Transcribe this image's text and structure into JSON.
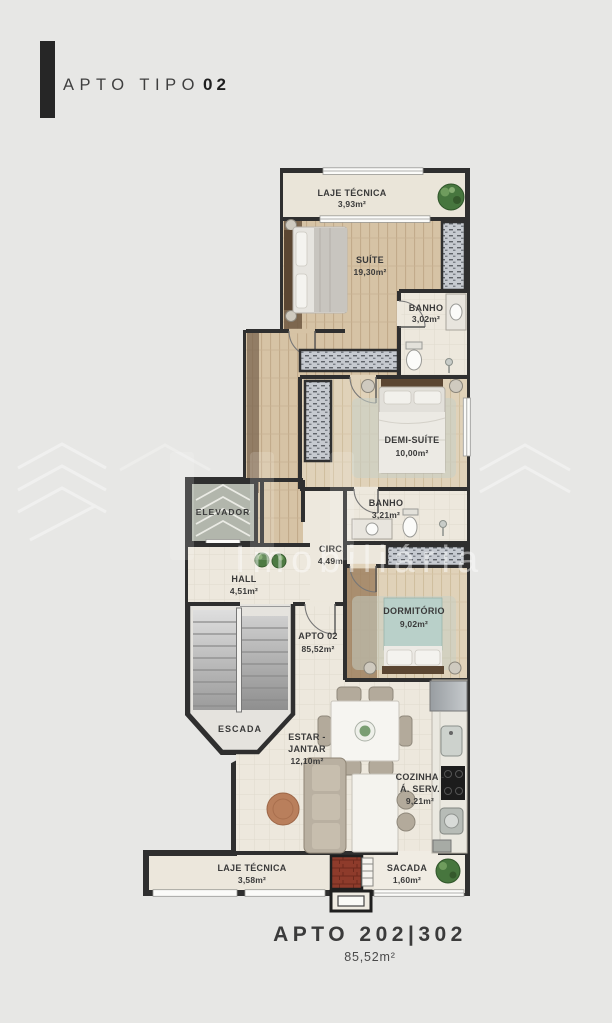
{
  "title": {
    "label": "APTO TIPO",
    "number": "02"
  },
  "rooms": {
    "laje_top": {
      "name": "LAJE TÉCNICA",
      "area": "3,93m²"
    },
    "suite": {
      "name": "SUÍTE",
      "area": "19,30m²"
    },
    "banho1": {
      "name": "BANHO",
      "area": "3,02m²"
    },
    "demi_suite": {
      "name": "DEMI-SUÍTE",
      "area": "10,00m²"
    },
    "banho2": {
      "name": "BANHO",
      "area": "3,21m²"
    },
    "circ": {
      "name": "CIRC.",
      "area": "4,49m²"
    },
    "elevador": {
      "name": "ELEVADOR"
    },
    "hall": {
      "name": "HALL",
      "area": "4,51m²"
    },
    "dormitorio": {
      "name": "DORMITÓRIO",
      "area": "9,02m²"
    },
    "apto": {
      "name": "APTO 02",
      "area": "85,52m²"
    },
    "escada": {
      "name": "ESCADA"
    },
    "estar": {
      "l1": "ESTAR -",
      "l2": "JANTAR",
      "area": "12,10m²"
    },
    "cozinha": {
      "l1": "COZINHA -",
      "l2": "Á. SERV.",
      "area": "9,21m²"
    },
    "laje_bottom": {
      "name": "LAJE TÉCNICA",
      "area": "3,58m²"
    },
    "sacada": {
      "name": "SACADA",
      "area": "1,60m²"
    }
  },
  "watermark": {
    "text": "Imobiliária"
  },
  "footer": {
    "unit": "APTO 202|302",
    "area": "85,52m²"
  },
  "colors": {
    "background": "#e7e7e5",
    "wall": "#2f2f2f",
    "floor_beige": "#ece7dc",
    "floor_wood": "#d6c3a5",
    "plant_green": "#4d7a43",
    "label_text": "#3a3a3a",
    "brick": "#8e3b2b"
  }
}
